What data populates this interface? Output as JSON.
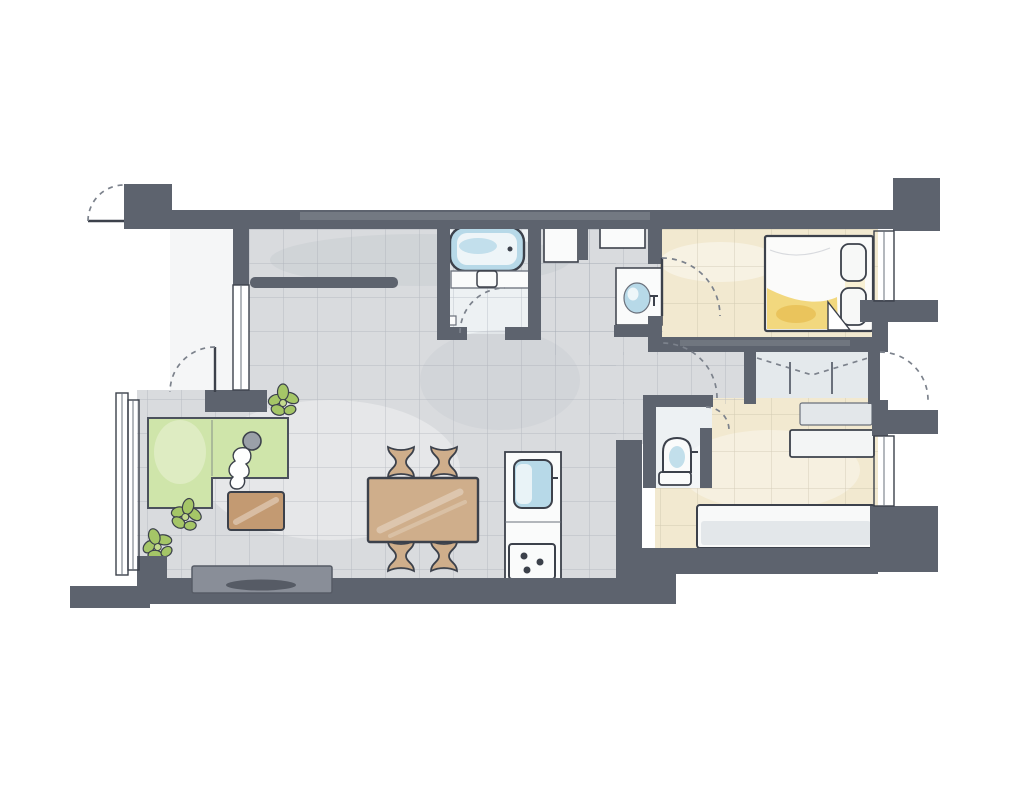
{
  "scene": {
    "kind": "apartment-floor-plan",
    "style": "hand-drawn-watercolor",
    "rooms": [
      "entry",
      "living-dining-kitchen",
      "bathroom",
      "washroom",
      "bedroom-1",
      "bedroom-2",
      "toilet",
      "closet",
      "balcony"
    ],
    "fixtures": [
      "bathtub",
      "bathroom-vanity",
      "washroom-vanity-basin",
      "toilet",
      "kitchen-counter",
      "kitchen-sink",
      "gas-stove"
    ],
    "furniture": [
      "corner-sofa",
      "person-on-sofa",
      "coffee-table",
      "tv-board",
      "tv",
      "dining-table",
      "dining-chair-x4",
      "double-bed",
      "pillow-x2",
      "single-bed",
      "desk",
      "shelf",
      "potted-plant-x3"
    ],
    "openings": [
      "entry-door",
      "living-room-door",
      "bathroom-door",
      "bedroom-1-door",
      "bedroom-2-door",
      "toilet-door",
      "side-exterior-door",
      "closet-folding-door",
      "window-x5"
    ]
  },
  "palette": {
    "paper": "#ffffff",
    "wall": "#5d636e",
    "wall_light": "#7a808b",
    "outline": "#3c414b",
    "outline_soft": "#6a707b",
    "door_arc": "#7c828c",
    "floor_tile": "#d9dbde",
    "tile_line": "#9aa0aa",
    "floor_wash_dark": "#c3c7cd",
    "floor_wood": "#f2e9d0",
    "wood_line": "#b4ac93",
    "bathroom_floor": "#edf1f3",
    "closet_floor": "#e4e9ec",
    "entry_floor": "#f2f3f4",
    "water_blue": "#b7d9e8",
    "water_blue_light": "#eef5f8",
    "rug_green": "#cfe5aa",
    "rug_green_light": "#e1eec8",
    "table_wood": "#cfae8b",
    "coffee_table_wood": "#c39a72",
    "furniture_gray": "#e3e7ea",
    "fixture_white": "#fafbfb",
    "tv_board_gray": "#898e98",
    "tv_dark": "#565b65",
    "bed_yellow": "#f2d87e",
    "bed_yellow_deep": "#e7bd52",
    "plant_green": "#a5c667",
    "plant_green_light": "#c4da8e",
    "person_gray": "#9aa0a8"
  }
}
